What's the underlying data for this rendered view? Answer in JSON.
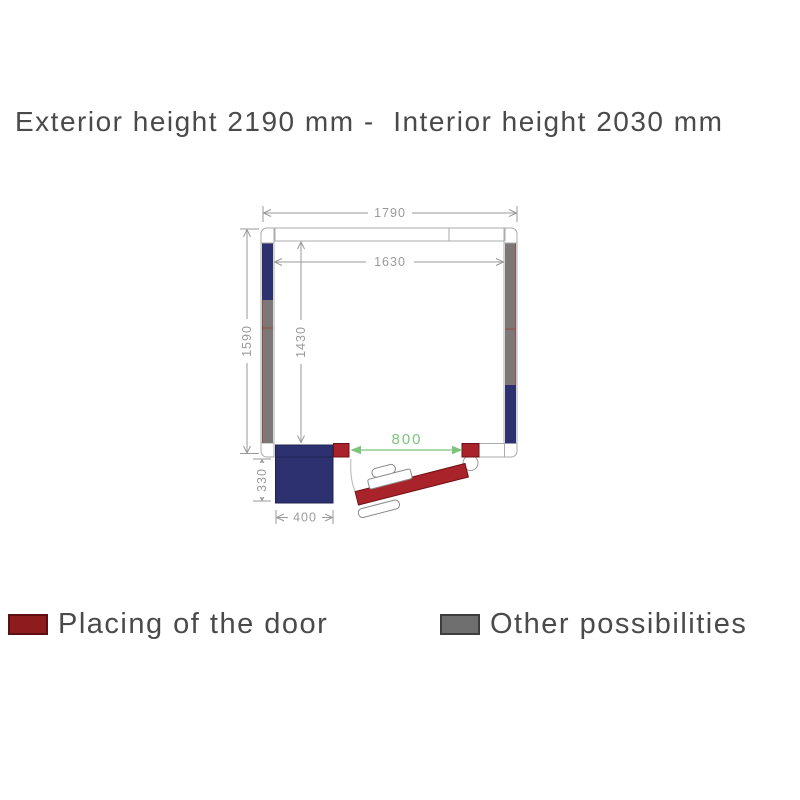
{
  "title": "Exterior height 2190 mm -  Interior height 2030 mm",
  "plan": {
    "dims": {
      "outer_width": "1790",
      "inner_width": "1630",
      "outer_depth": "1590",
      "inner_depth": "1430",
      "door_width": "800",
      "block_depth": "330",
      "block_width": "400"
    },
    "colors": {
      "door_red": "#a8232a",
      "wall_gray": "#7d7878",
      "unit_blue": "#2d3170",
      "dim_green": "#7cc47c",
      "dim_gray": "#9a9a9a",
      "outline": "#ababab",
      "divider_red": "#9c3c3c"
    }
  },
  "legend": {
    "door": {
      "label": "Placing of the door",
      "color": "#8e1b1e"
    },
    "other": {
      "label": "Other possibilities",
      "color": "#6f6f6f"
    }
  }
}
